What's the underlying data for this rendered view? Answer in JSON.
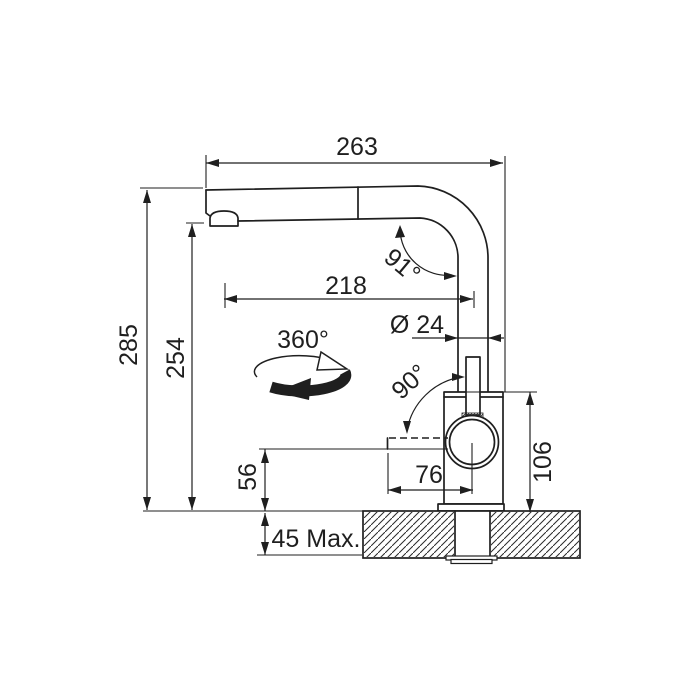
{
  "drawing": {
    "description": "kitchen faucet installation dimension drawing",
    "labels": {
      "width_total": "263",
      "reach": "218",
      "height_total": "285",
      "height_spout": "254",
      "spout_angle": "91°",
      "diameter": "Ø 24",
      "swivel": "360°",
      "handle_angle": "90°",
      "body_height": "106",
      "handle_reach": "76",
      "handle_clearance": "56",
      "deck_thickness": "45 Max."
    },
    "colors": {
      "line": "#1f1f1f",
      "background": "#ffffff"
    }
  }
}
